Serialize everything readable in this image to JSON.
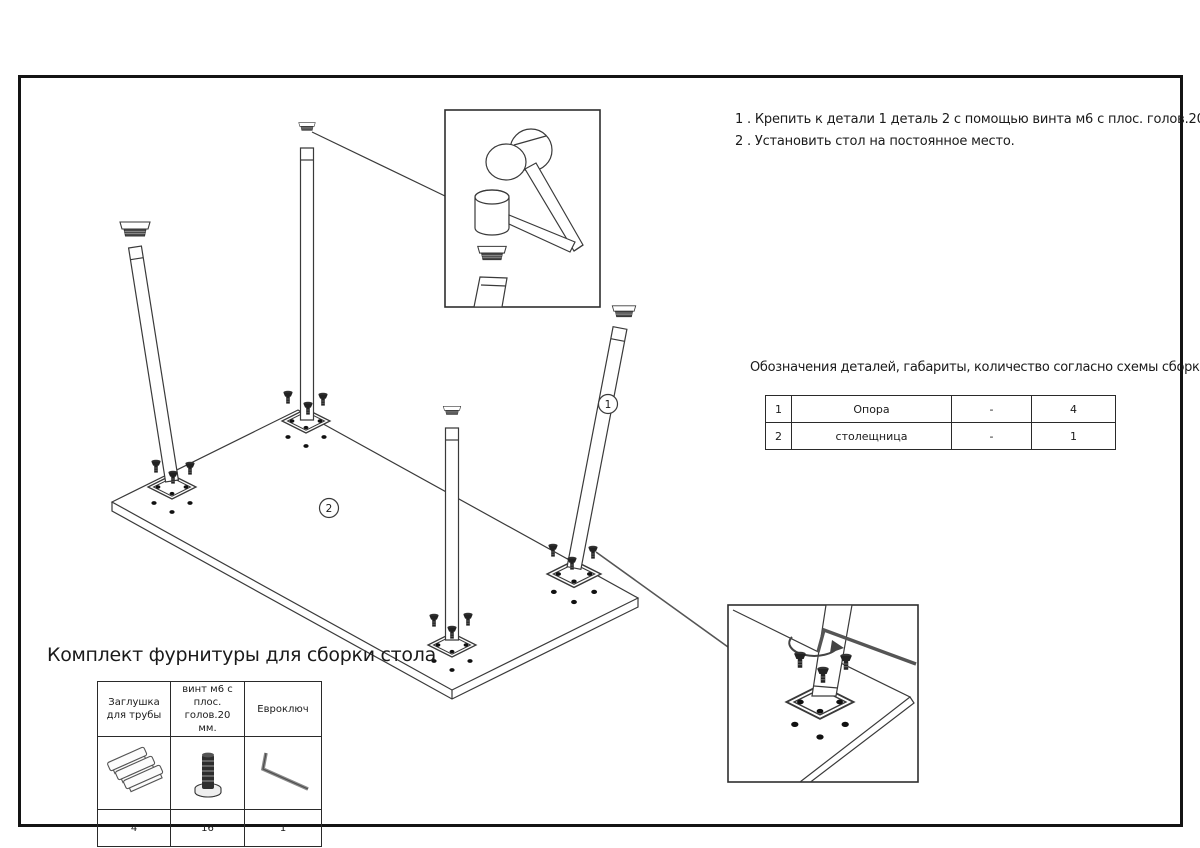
{
  "frame": {
    "line_color": "#1a1a1a"
  },
  "instructions": {
    "line1": "1 . Крепить к детали 1 деталь 2 с помощью винта м6 с плос. голов.20 мм.",
    "line2": "2 . Установить стол на постоянное место."
  },
  "parts_section": {
    "title": "Обозначения деталей, габариты, количество согласно схемы сборки",
    "rows": [
      {
        "num": "1",
        "name": "Опора",
        "dims": "-",
        "qty": "4"
      },
      {
        "num": "2",
        "name": "столещница",
        "dims": "-",
        "qty": "1"
      }
    ]
  },
  "hardware_kit": {
    "title": "Комплект фурнитуры для сборки стола",
    "columns": [
      {
        "label": "Заглушка для трубы",
        "icon": "pipe-cap-stack-icon",
        "qty": "4"
      },
      {
        "label": "винт м6 с плос. голов.20 мм.",
        "icon": "flat-head-screw-icon",
        "qty": "16"
      },
      {
        "label": "Евроключ",
        "icon": "hex-key-icon",
        "qty": "1"
      }
    ]
  },
  "diagram": {
    "labels": {
      "part1": "1",
      "part2": "2"
    }
  }
}
